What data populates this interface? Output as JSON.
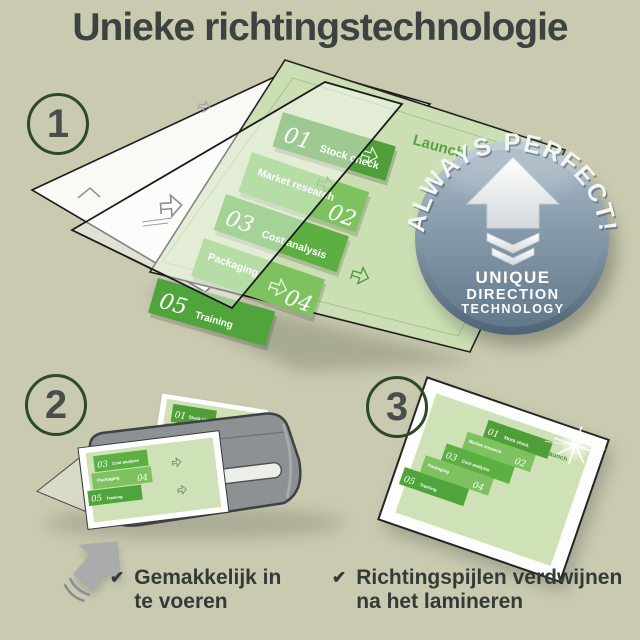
{
  "title": "Unieke richtingstechnologie",
  "steps": [
    {
      "number": "1"
    },
    {
      "number": "2"
    },
    {
      "number": "3"
    }
  ],
  "badge": {
    "arc_text": "ALWAYS PERFECT!",
    "line1": "UNIQUE",
    "line2": "DIRECTION",
    "line3": "TECHNOLOGY"
  },
  "process_document": {
    "launch_label": "Launch",
    "items": [
      {
        "num": "01",
        "label": "Stock check"
      },
      {
        "num": "02",
        "label": "Market research"
      },
      {
        "num": "03",
        "label": "Cost analysis"
      },
      {
        "num": "04",
        "label": "Packaging"
      },
      {
        "num": "05",
        "label": "Training"
      }
    ]
  },
  "checklist": [
    {
      "line1": "Gemakkelijk in",
      "line2": "te voeren"
    },
    {
      "line1": "Richtingspijlen verdwijnen",
      "line2": "na het lamineren"
    }
  ],
  "icons": {
    "check": "✔"
  },
  "colors": {
    "background": "#c9cab0",
    "title_text": "#3b4240",
    "circle_ring": "#2c4a23",
    "step_number": "#4a4e4b",
    "green_dark": "#4f9e38",
    "green_mid": "#7dc25e",
    "green_deep": "#5cb042",
    "green_page": "#cfe1b7",
    "badge_top": "#bdccd6",
    "badge_bottom": "#4e6476",
    "laminator_gray": "#8d9193",
    "check_text": "#333a37"
  }
}
